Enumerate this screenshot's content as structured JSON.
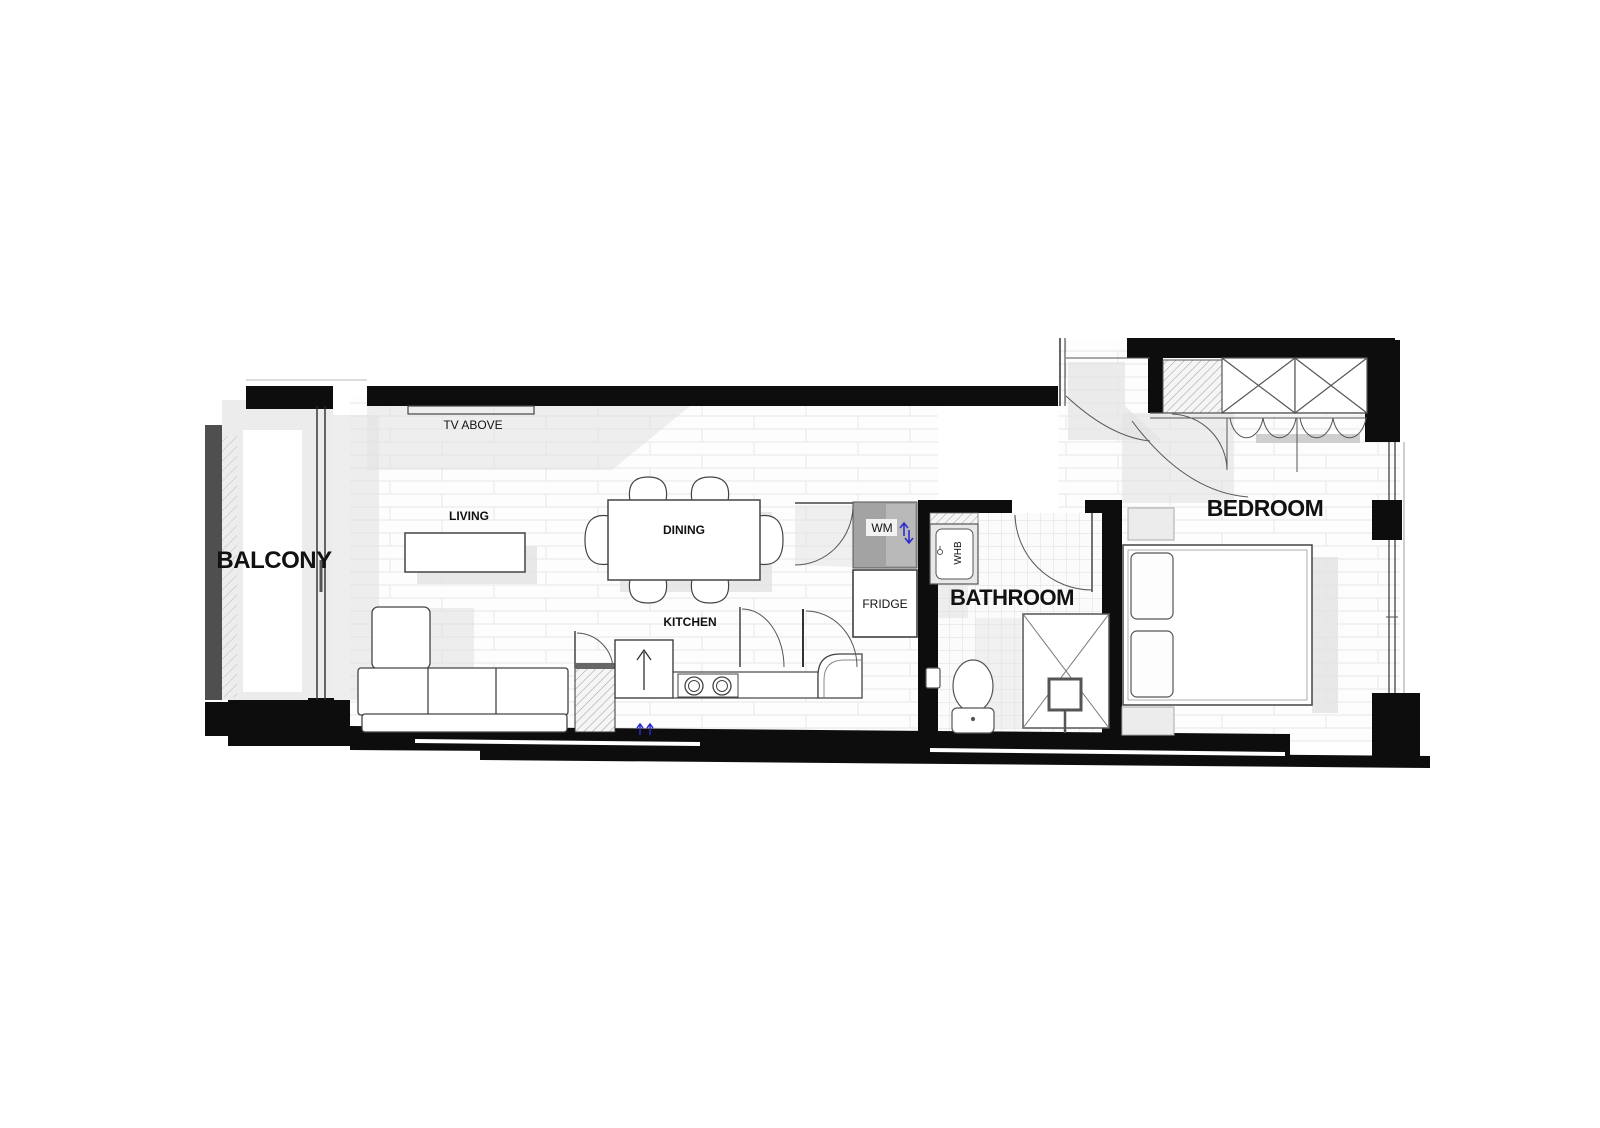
{
  "plan_title": "apartment-floor-plan",
  "rooms": {
    "balcony": "BALCONY",
    "living": "LIVING",
    "dining": "DINING",
    "kitchen": "KITCHEN",
    "bathroom": "BATHROOM",
    "bedroom": "BEDROOM"
  },
  "annotations": {
    "tv": "TV ABOVE",
    "washing_machine": "WM",
    "fridge": "FRIDGE",
    "wash_basin": "WHB"
  },
  "colors": {
    "wall": "#0d0d0d",
    "furniture_outline": "#444444",
    "appliance_gray": "#a3a3a3",
    "rail_gray": "#4f4f4f",
    "shadow": "#e2e2e2",
    "floor_line": "#e7e7e7",
    "tile_line": "#dcdcdc",
    "marker_blue": "#2b2bd0",
    "background": "#ffffff"
  }
}
